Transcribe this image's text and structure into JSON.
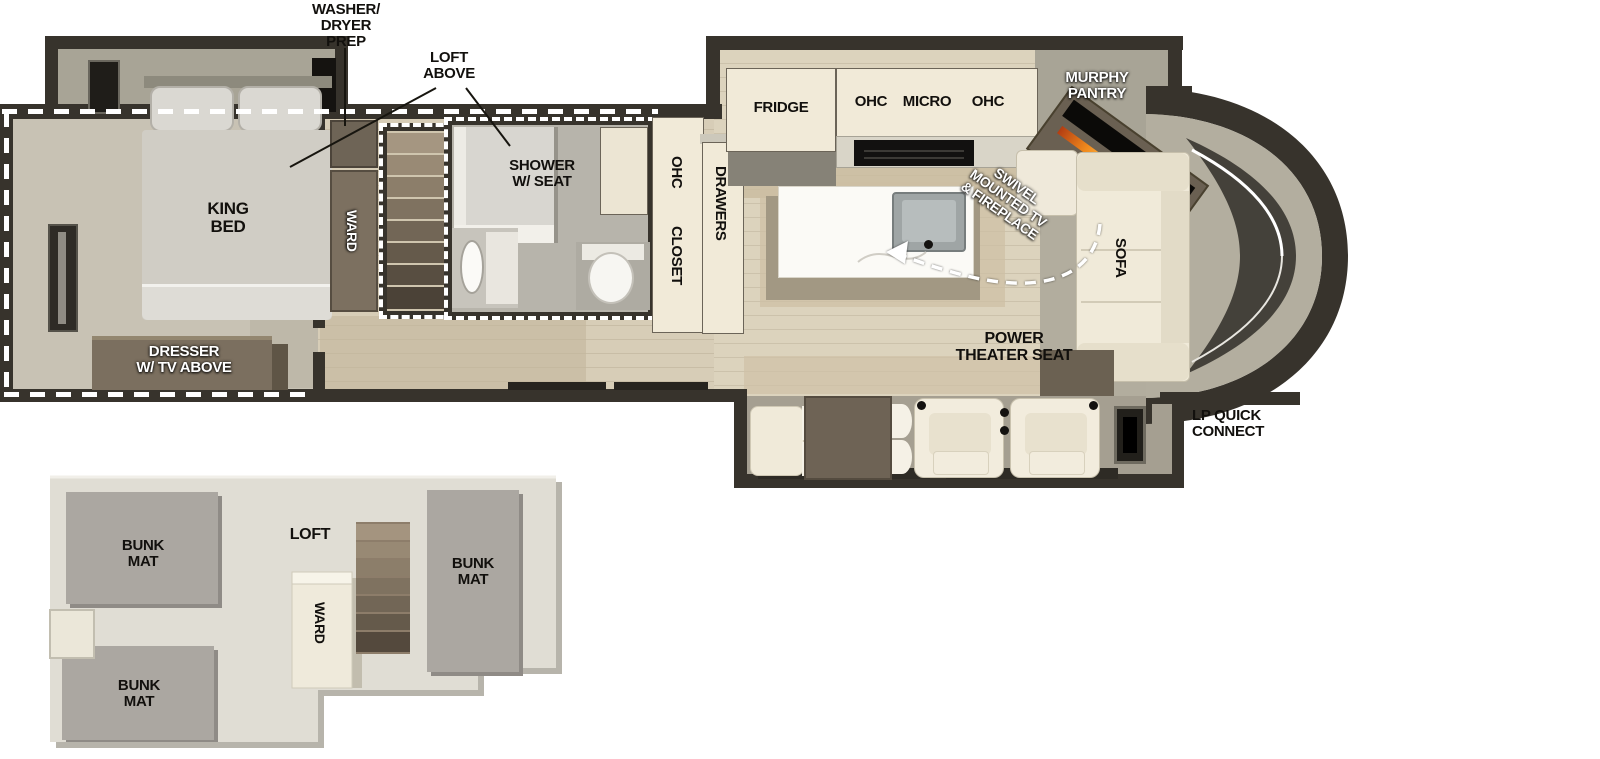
{
  "title": "RV floor plan with loft",
  "colors": {
    "wall": "#37332c",
    "wood_floor": "#dcd3bd",
    "carpet": "#c8c2b4",
    "slide_floor": "#a8a496",
    "cabinet_cream": "#f1ead8",
    "furniture_brown": "#6e6355",
    "upholstery": "#f0ead9",
    "bunk_gray": "#aba7a1",
    "loft_slab": "#e0ddd4",
    "flame_orange": "#f08a1d"
  },
  "main_plan": {
    "callouts": {
      "washer_dryer": "WASHER/\nDRYER\nPREP",
      "loft_above": "LOFT\nABOVE",
      "swivel_tv": "SWIVEL\nMOUNTED TV\n& FIREPLACE",
      "lp_quick_connect": "LP QUICK\nCONNECT"
    },
    "bedroom": {
      "king_bed": "KING\nBED",
      "ward": "WARD",
      "dresser": "DRESSER\nW/ TV ABOVE"
    },
    "bathroom": {
      "shower": "SHOWER\nW/ SEAT",
      "ohc": "OHC",
      "closet": "CLOSET",
      "drawers": "DRAWERS"
    },
    "kitchen": {
      "fridge": "FRIDGE",
      "ohc_left": "OHC",
      "micro": "MICRO",
      "ohc_right": "OHC",
      "murphy_pantry": "MURPHY\nPANTRY"
    },
    "living": {
      "sofa": "SOFA",
      "theater_seat": "POWER\nTHEATER SEAT"
    }
  },
  "loft_plan": {
    "loft": "LOFT",
    "ward": "WARD",
    "bunk_top": "BUNK\nMAT",
    "bunk_bottom": "BUNK\nMAT",
    "bunk_right": "BUNK\nMAT"
  }
}
